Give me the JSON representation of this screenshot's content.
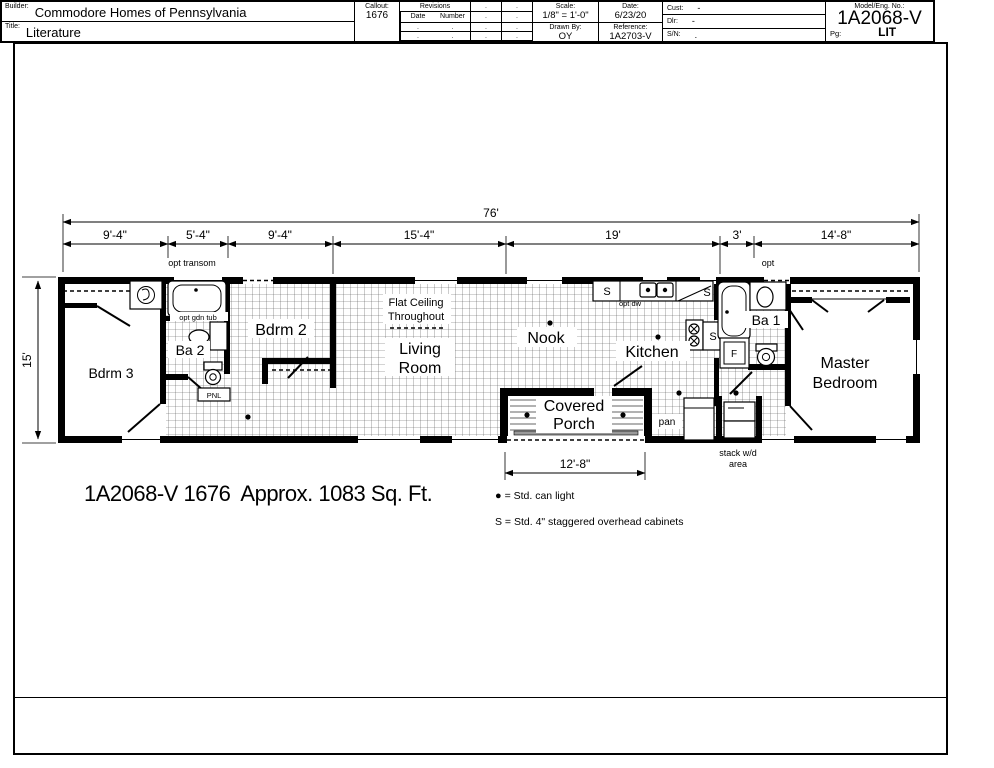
{
  "drawing": {
    "plan_title": "1A2068-V 1676  Approx. 1083 Sq. Ft.",
    "legend_can_light_symbol": "●",
    "legend_can_light": "= Std. can light",
    "legend_cabinets": "S = Std. 4\" staggered overhead cabinets"
  },
  "dims": {
    "overall": "76'",
    "left_height": "15'",
    "seg1": "9'-4\"",
    "seg2": "5'-4\"",
    "seg3": "9'-4\"",
    "seg4": "15'-4\"",
    "seg5": "19'",
    "seg6": "3'",
    "seg7": "14'-8\"",
    "porch": "12'-8\""
  },
  "rooms": {
    "bdrm3": "Bdrm 3",
    "ba2": "Ba 2",
    "bdrm2": "Bdrm 2",
    "living_1": "Living",
    "living_2": "Room",
    "nook": "Nook",
    "kitchen": "Kitchen",
    "ba1": "Ba 1",
    "master_1": "Master",
    "master_2": "Bedroom",
    "porch_1": "Covered",
    "porch_2": "Porch"
  },
  "notes": {
    "flat_ceiling_1": "Flat Ceiling",
    "flat_ceiling_2": "Throughout",
    "opt_transom": "opt transom",
    "opt": "opt",
    "opt_gdn_tub": "opt gdn tub",
    "opt_dw": "opt dw",
    "pnl": "PNL",
    "pan": "pan",
    "stack_1": "stack w/d",
    "stack_2": "area",
    "s": "S",
    "f": "F"
  },
  "title_block": {
    "builder_label": "Builder:",
    "builder": "Commodore Homes of Pennsylvania",
    "title_label": "Title:",
    "title": "Literature",
    "callout_label": "Callout:",
    "callout": "1676",
    "revisions_label": "Revisions",
    "rev_date_label": "Date",
    "rev_number_label": "Number",
    "dot": ".",
    "scale_label": "Scale:",
    "scale_value": "1/8\" = 1'-0\"",
    "date_label": "Date:",
    "date_value": "6/23/20",
    "drawn_label": "Drawn By:",
    "drawn_value": "OY",
    "ref_label": "Reference:",
    "ref_value": "1A2703-V",
    "cust_label": "Cust:",
    "cust_value": "-",
    "dlr_label": "Dlr:",
    "dlr_value": "-",
    "sn_label": "S/N:",
    "sn_value": ".",
    "model_label": "Model/Eng. No.:",
    "model_value": "1A2068-V",
    "pg_label": "Pg:",
    "pg_value": "LIT"
  }
}
